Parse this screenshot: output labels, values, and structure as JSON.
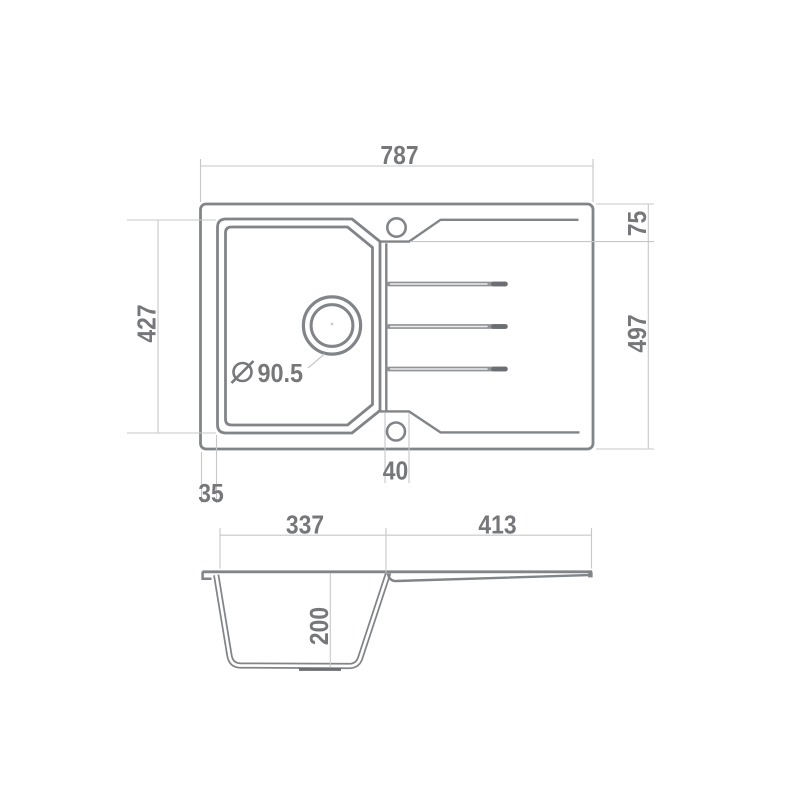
{
  "colors": {
    "line": "#818488",
    "dim": "#c5c7c9",
    "text": "#75777a",
    "groove": "#919396",
    "groove_dark": "#6b6e72",
    "background": "#ffffff"
  },
  "top_view": {
    "overall_width": "787",
    "rim_to_recess": "75",
    "overall_depth": "497",
    "bowl_length": "427",
    "bowl_edge_offset": "35",
    "tap_hole_offset": "40",
    "drain_symbol_icon": "diameter-icon",
    "drain_diameter": "90.5"
  },
  "side_view": {
    "bowl_width": "337",
    "drainboard_width": "413",
    "bowl_depth": "200"
  }
}
